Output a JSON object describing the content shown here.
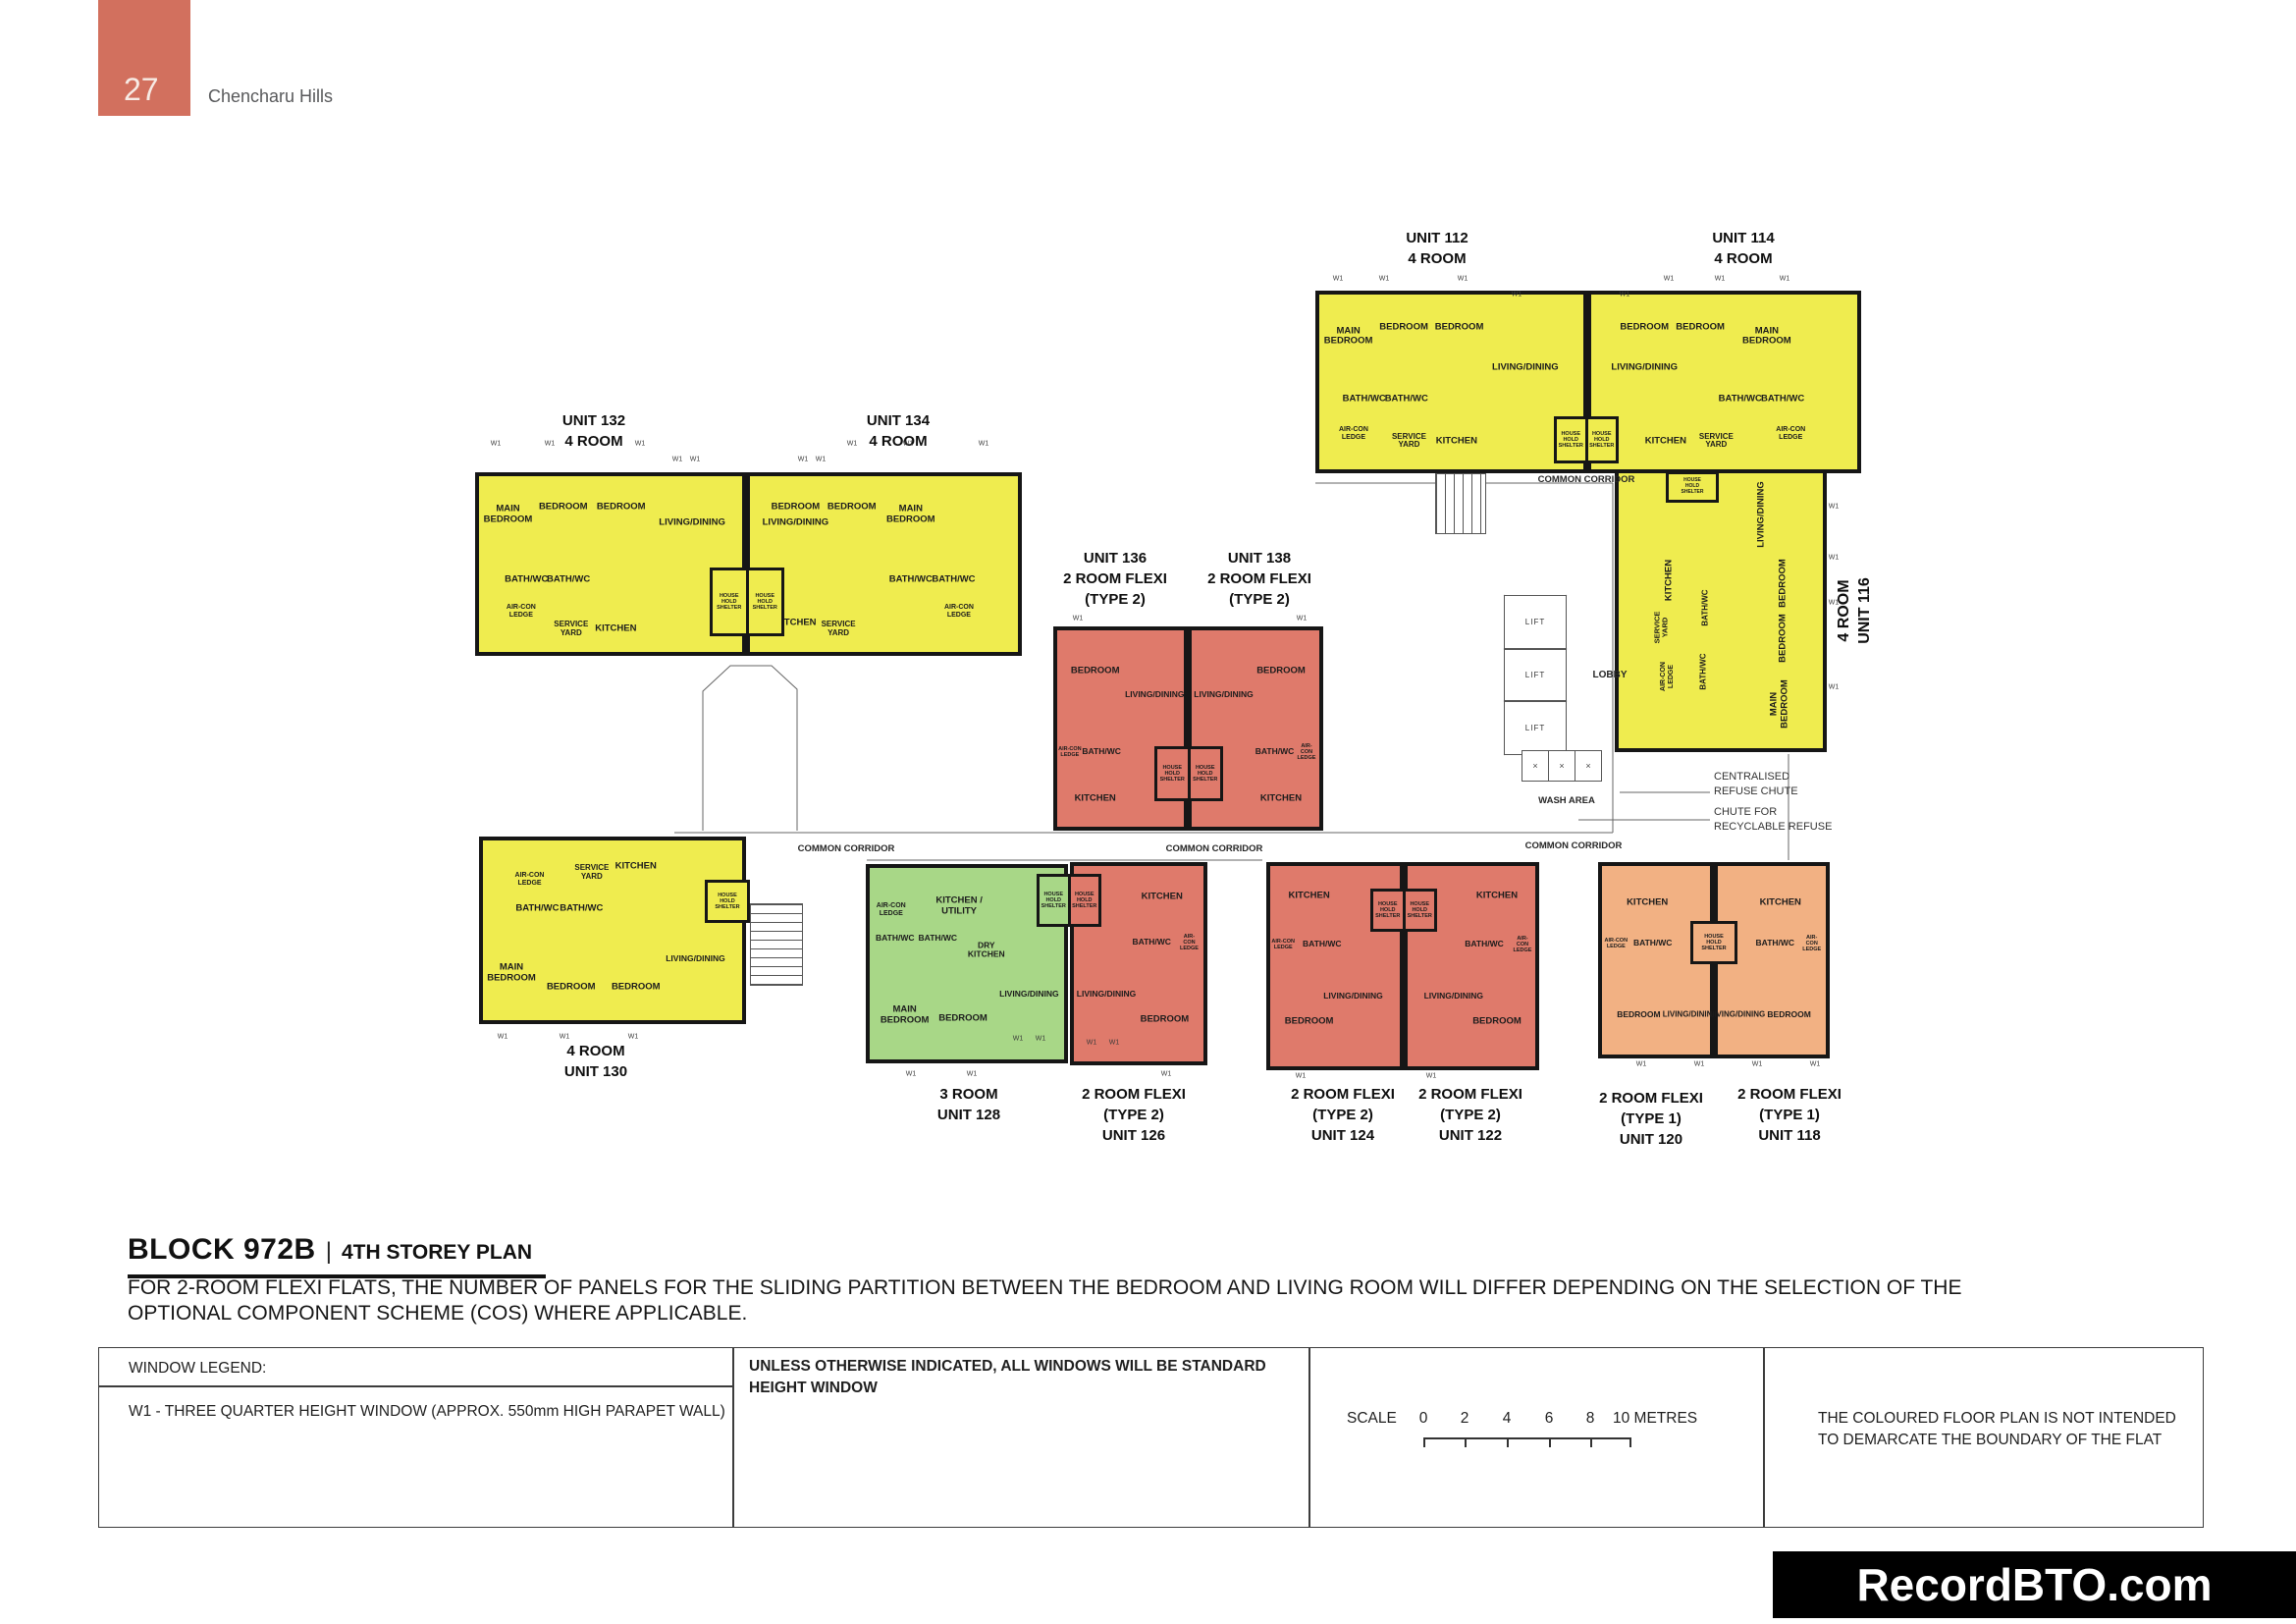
{
  "page": {
    "number": "27",
    "project_name": "Chencharu Hills"
  },
  "colors": {
    "header_badge": "#D2705E",
    "wall": "#161616",
    "four_room": "#EFEC4F",
    "three_room": "#A8D787",
    "two_room_flexi_type2": "#DF7A6B",
    "two_room_flexi_type1": "#F2B183",
    "watermark_bg": "#000000"
  },
  "rooms": {
    "main_bedroom": "MAIN\nBEDROOM",
    "bedroom": "BEDROOM",
    "living": "LIVING/DINING",
    "bath": "BATH/WC",
    "kitchen": "KITCHEN",
    "kitchen_utility": "KITCHEN /\nUTILITY",
    "dry_kitchen": "DRY\nKITCHEN",
    "service_yard": "SERVICE\nYARD",
    "aircon": "AIR-CON\nLEDGE",
    "hhs": "HOUSE\nHOLD\nSHELTER"
  },
  "plan": {
    "common_corridor": "COMMON CORRIDOR",
    "lobby": "LOBBY",
    "lift": "LIFT",
    "wash_area": "WASH AREA",
    "wash_x": "×",
    "window_mark": "W1",
    "refuse_chute": "CENTRALISED\nREFUSE CHUTE",
    "recyclable_chute": "CHUTE FOR\nRECYCLABLE REFUSE"
  },
  "units": [
    {
      "id": "112",
      "lines": [
        "UNIT 112",
        "4 ROOM"
      ]
    },
    {
      "id": "114",
      "lines": [
        "UNIT 114",
        "4 ROOM"
      ]
    },
    {
      "id": "132",
      "lines": [
        "UNIT 132",
        "4 ROOM"
      ]
    },
    {
      "id": "134",
      "lines": [
        "UNIT 134",
        "4 ROOM"
      ]
    },
    {
      "id": "136",
      "lines": [
        "UNIT 136",
        "2 ROOM FLEXI",
        "(TYPE 2)"
      ]
    },
    {
      "id": "138",
      "lines": [
        "UNIT 138",
        "2 ROOM FLEXI",
        "(TYPE 2)"
      ]
    },
    {
      "id": "116",
      "lines": [
        "4 ROOM",
        "UNIT 116"
      ]
    },
    {
      "id": "130",
      "lines": [
        "4 ROOM",
        "UNIT 130"
      ]
    },
    {
      "id": "128",
      "lines": [
        "3 ROOM",
        "UNIT 128"
      ]
    },
    {
      "id": "126",
      "lines": [
        "2 ROOM FLEXI",
        "(TYPE 2)",
        "UNIT 126"
      ]
    },
    {
      "id": "124",
      "lines": [
        "2 ROOM FLEXI",
        "(TYPE 2)",
        "UNIT 124"
      ]
    },
    {
      "id": "122",
      "lines": [
        "2 ROOM FLEXI",
        "(TYPE 2)",
        "UNIT 122"
      ]
    },
    {
      "id": "120",
      "lines": [
        "2 ROOM FLEXI",
        "(TYPE 1)",
        "UNIT 120"
      ]
    },
    {
      "id": "118",
      "lines": [
        "2 ROOM FLEXI",
        "(TYPE 1)",
        "UNIT 118"
      ]
    }
  ],
  "footer": {
    "block_title": "BLOCK 972B",
    "separator": "|",
    "storey_title": "4TH STOREY PLAN",
    "note_line_1": "FOR 2-ROOM FLEXI FLATS, THE NUMBER OF PANELS FOR THE SLIDING PARTITION BETWEEN THE BEDROOM AND LIVING ROOM WILL DIFFER DEPENDING ON THE SELECTION OF THE",
    "note_line_2": "OPTIONAL COMPONENT SCHEME (COS) WHERE APPLICABLE.",
    "legend": {
      "title": "WINDOW LEGEND:",
      "w1_desc": "W1 - THREE QUARTER HEIGHT WINDOW (APPROX. 550mm HIGH PARAPET WALL)",
      "windows_note_1": "UNLESS OTHERWISE INDICATED, ALL WINDOWS WILL BE STANDARD",
      "windows_note_2": "HEIGHT WINDOW",
      "scale_label": "SCALE",
      "scale_ticks": [
        "0",
        "2",
        "4",
        "6",
        "8"
      ],
      "scale_unit": "10 METRES",
      "disclaimer_1": "THE COLOURED FLOOR PLAN IS NOT INTENDED",
      "disclaimer_2": "TO DEMARCATE THE BOUNDARY OF THE FLAT"
    }
  },
  "watermark": "RecordBTO.com"
}
